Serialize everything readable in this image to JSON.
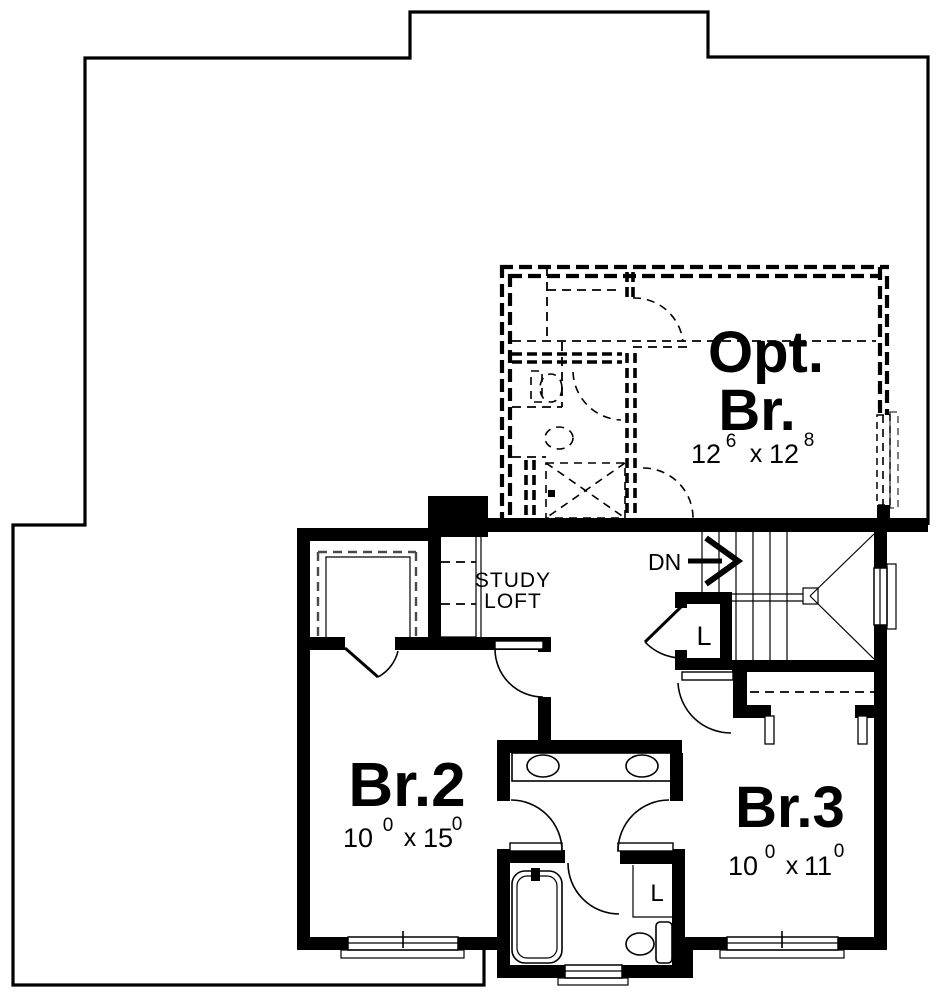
{
  "plan": {
    "optional_bedroom": {
      "label_line1": "Opt.",
      "label_line2": "Br.",
      "dim": {
        "a": "12",
        "a_sup": "6",
        "sep": "x",
        "b": "12",
        "b_sup": "8"
      }
    },
    "study_loft": {
      "label_line1": "STUDY",
      "label_line2": "LOFT"
    },
    "stairs": {
      "down_label": "DN"
    },
    "hall_linen_closet": {
      "label": "L"
    },
    "bath_linen_closet": {
      "label": "L"
    },
    "bedroom2": {
      "label": "Br.2",
      "dim": {
        "a": "10",
        "a_sup": "0",
        "sep": "x",
        "b": "15",
        "b_sup": "0"
      }
    },
    "bedroom3": {
      "label": "Br.3",
      "dim": {
        "a": "10",
        "a_sup": "0",
        "sep": "x",
        "b": "11",
        "b_sup": "0"
      }
    }
  },
  "colors": {
    "line": "#000000",
    "background": "#ffffff"
  }
}
